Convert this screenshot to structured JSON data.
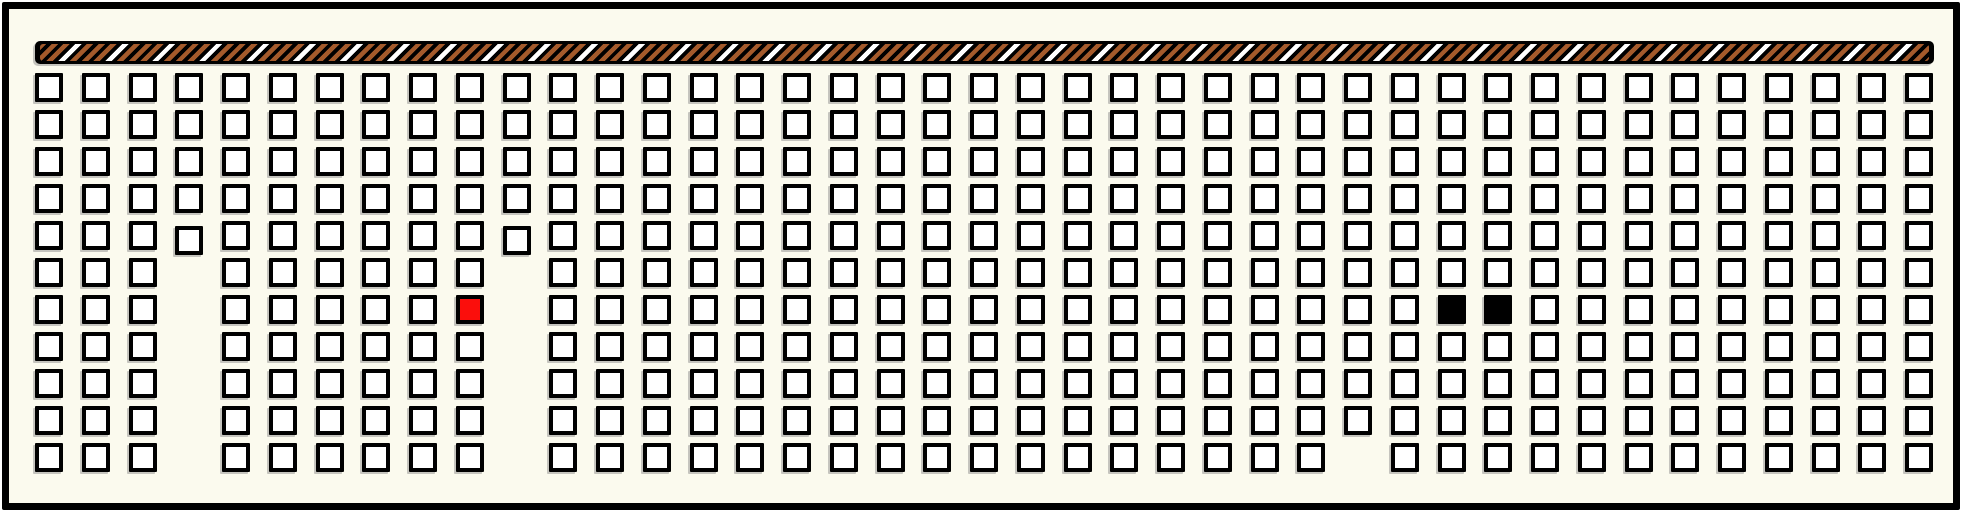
{
  "figure": {
    "kind": "seat-map-grid-with-striped-header-bar",
    "canvas": {
      "width": 1966,
      "height": 517
    },
    "colors": {
      "outside": "#FFFFFF",
      "background": "#FBFAEE",
      "line": "#000000",
      "seat_fill": "#FFFFFF",
      "selected_red": "#FB0E0C",
      "occupied_black": "#000000",
      "bar_black": "#000000",
      "stripe_brown": "#A45A2B",
      "stripe_white": "#FFFFFF",
      "shadow": "rgba(130,130,130,0.45)"
    },
    "frame": {
      "x": 2,
      "y": 2,
      "width": 1958,
      "height": 508,
      "border_width": 7
    },
    "bar": {
      "x": 35,
      "y": 41,
      "width": 1899,
      "height": 23
    },
    "grid": {
      "cols": 41,
      "rows": 11,
      "origin_x": 35,
      "origin_y": 73,
      "col_pitch": 46.75,
      "row_pitch": 37,
      "seat_width": 28,
      "seat_height": 29
    },
    "seats": {
      "missing": [
        [
          3,
          5
        ],
        [
          3,
          6
        ],
        [
          3,
          7
        ],
        [
          3,
          8
        ],
        [
          3,
          9
        ],
        [
          3,
          10
        ],
        [
          10,
          5
        ],
        [
          10,
          6
        ],
        [
          10,
          7
        ],
        [
          10,
          8
        ],
        [
          10,
          9
        ],
        [
          10,
          10
        ],
        [
          28,
          10
        ]
      ],
      "nudged_down": [
        [
          3,
          4
        ],
        [
          10,
          4
        ]
      ],
      "nudge_dy": 5,
      "selected_red": [
        [
          9,
          6
        ]
      ],
      "occupied_black": [
        [
          30,
          6
        ],
        [
          31,
          6
        ]
      ]
    }
  }
}
